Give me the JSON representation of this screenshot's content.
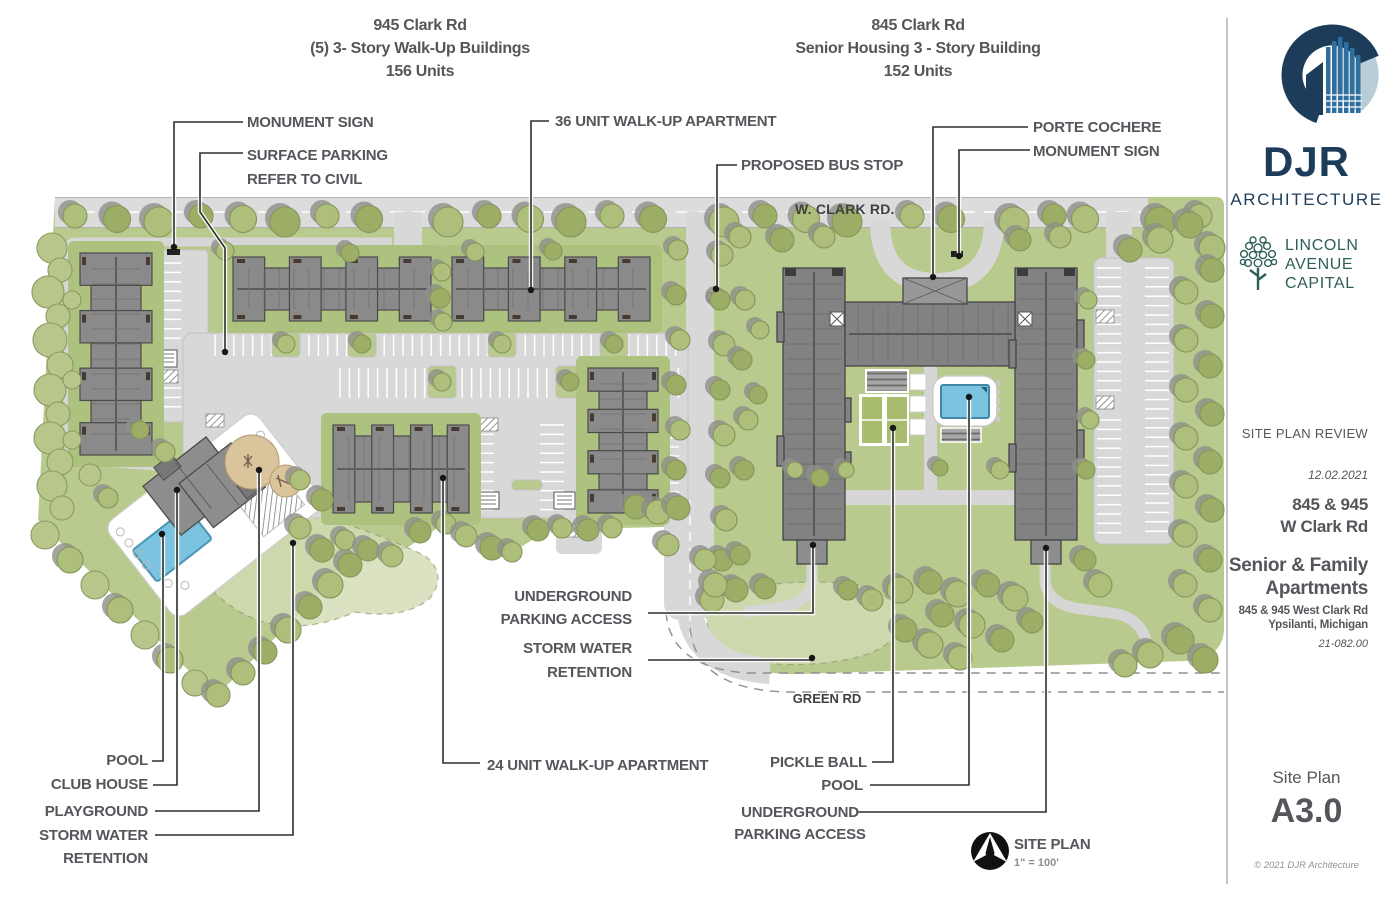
{
  "header_left": {
    "line1": "945 Clark Rd",
    "line2": "(5) 3- Story Walk-Up Buildings",
    "line3": "156 Units"
  },
  "header_right": {
    "line1": "845 Clark Rd",
    "line2": "Senior Housing 3 - Story Building",
    "line3": "152 Units"
  },
  "roads": {
    "w_clark": "W. CLARK RD.",
    "green": "GREEN RD"
  },
  "plan_labels": {
    "monument_left": "MONUMENT SIGN",
    "surface_parking_1": "SURFACE PARKING",
    "surface_parking_2": "REFER TO CIVIL",
    "walkup36": "36 UNIT  WALK-UP APARTMENT",
    "bus_stop": "PROPOSED BUS STOP",
    "porte_cochere": "PORTE COCHERE",
    "monument_right": "MONUMENT SIGN",
    "underground_mid_1": "UNDERGROUND",
    "underground_mid_2": "PARKING ACCESS",
    "storm_mid_1": "STORM WATER",
    "storm_mid_2": "RETENTION",
    "pool_left": "POOL",
    "club_house": "CLUB HOUSE",
    "playground": "PLAYGROUND",
    "storm_left_1": "STORM WATER",
    "storm_left_2": "RETENTION",
    "walkup24": "24 UNIT WALK-UP APARTMENT",
    "pickle_ball": "PICKLE BALL",
    "pool_right": "POOL",
    "underground_bot_1": "UNDERGROUND",
    "underground_bot_2": "PARKING ACCESS"
  },
  "compass": {
    "title": "SITE PLAN",
    "scale": "1\" = 100'"
  },
  "sidebar": {
    "firm_name": "DJR",
    "firm_sub": "ARCHITECTURE",
    "partner_line1": "LINCOLN",
    "partner_line2": "AVENUE",
    "partner_line3": "CAPITAL",
    "review_status": "SITE PLAN REVIEW",
    "date": "12.02.2021",
    "address_line1": "845 & 945",
    "address_line2": "W Clark Rd",
    "project_line1": "Senior & Family",
    "project_line2": "Apartments",
    "sub_address_line1": "845 & 945 West Clark Rd",
    "sub_address_line2": "Ypsilanti,  Michigan",
    "project_number": "21-082.00",
    "sheet_title": "Site Plan",
    "sheet_number": "A3.0",
    "copyright": "© 2021 DJR Architecture"
  },
  "colors": {
    "accent_navy": "#1d3c59",
    "logo_light_blue": "#b9cdd9",
    "logo_mid_blue": "#2f6fa0",
    "lincoln_teal": "#2f5f5b",
    "label_gray": "#54565b",
    "landscape_green": "#b8ca8d",
    "building_pad_green": "#aec27f",
    "tree_olive": "#adbf7a",
    "tree_olive_dark": "#9cae66",
    "tree_pale": "#b9c68b",
    "tree_shadow": "#8e9089",
    "road_gray": "#d8d8d9",
    "building_gray": "#8a8a8a",
    "building_dark_gray": "#828282",
    "pool_blue": "#7cc3e0",
    "playground_tan": "#d9c49c",
    "storm_green": "#d3dcb4",
    "court_green": "#a7bd6d"
  }
}
